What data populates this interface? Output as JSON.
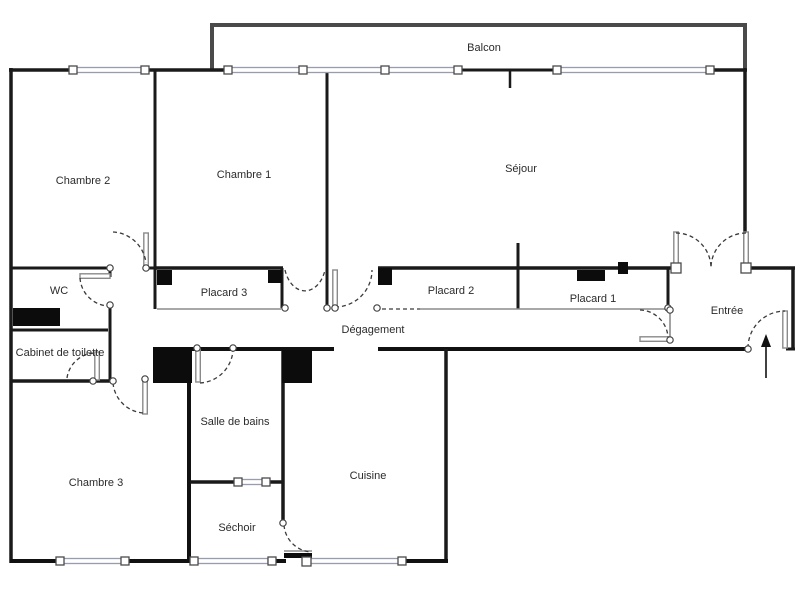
{
  "floorplan": {
    "type": "apartment-floor-plan",
    "rooms": {
      "balcon": "Balcon",
      "chambre2": "Chambre 2",
      "chambre1": "Chambre 1",
      "sejour": "Séjour",
      "wc": "WC",
      "placard3": "Placard 3",
      "placard2": "Placard 2",
      "placard1": "Placard 1",
      "degagement": "Dégagement",
      "entree": "Entrée",
      "cabinet_de_toilette": "Cabinet de toilette",
      "salle_de_bains": "Salle de bains",
      "chambre3": "Chambre 3",
      "sechoir": "Séchoir",
      "cuisine": "Cuisine"
    },
    "colors": {
      "wall": "#1a1a1a",
      "balcony_wall": "#4a4a4a",
      "window_frame": "#979dae",
      "background": "#ffffff",
      "label_text": "#2b2b2b"
    },
    "symbols": {
      "entrance_arrow_direction": "up"
    }
  }
}
